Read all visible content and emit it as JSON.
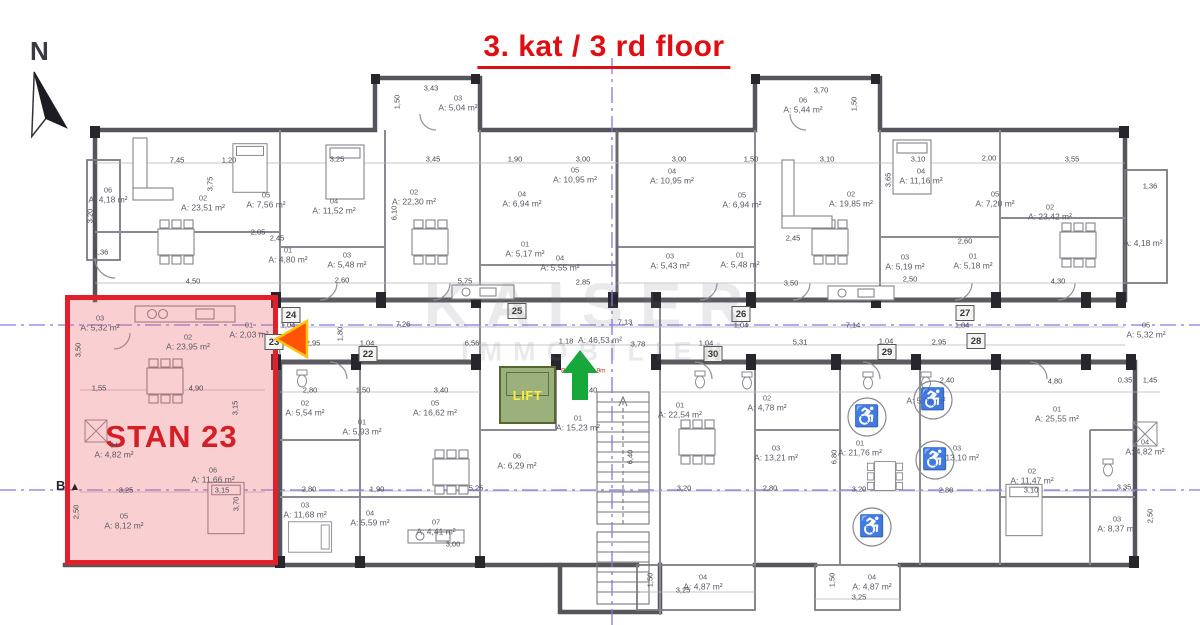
{
  "title": "3. kat / 3 rd floor",
  "compass": {
    "label": "N"
  },
  "section_marker": {
    "label": "B"
  },
  "watermark": {
    "line1": "KAISER",
    "line2": "IMMOBILIEN"
  },
  "highlight": {
    "label": "STAN 23"
  },
  "lift": {
    "label": "LIFT"
  },
  "icons": {
    "wheelchair": "♿"
  },
  "colors": {
    "highlight_border": "#e32029",
    "highlight_fill": "rgba(237,96,102,0.30)",
    "title_red": "#e00d12",
    "lift_green": "#9cb07c",
    "lift_text": "#f9f23b",
    "arrow_green": "#17a83b",
    "arrow_orange": "#ff5305",
    "axis_purple": "#8677e2"
  },
  "arrow_notes": [
    {
      "t": "B2",
      "x": 565,
      "y": 371
    },
    {
      "t": "-9m",
      "x": 600,
      "y": 371
    }
  ],
  "rooms": [
    {
      "u": "06",
      "a": "A: 4,18 m²",
      "x": 108,
      "y": 195
    },
    {
      "u": "02",
      "a": "A: 23,51 m²",
      "x": 203,
      "y": 203
    },
    {
      "u": "05",
      "a": "A: 7,56 m²",
      "x": 266,
      "y": 200
    },
    {
      "u": "01",
      "a": "A: 4,80 m²",
      "x": 288,
      "y": 255
    },
    {
      "u": "04",
      "a": "A: 11,52 m²",
      "x": 334,
      "y": 206
    },
    {
      "u": "03",
      "a": "A: 5,48 m²",
      "x": 347,
      "y": 260
    },
    {
      "u": "02",
      "a": "A: 22,30 m²",
      "x": 414,
      "y": 197
    },
    {
      "u": "03",
      "a": "A: 5,04 m²",
      "x": 458,
      "y": 103
    },
    {
      "u": "04",
      "a": "A: 6,94 m²",
      "x": 522,
      "y": 199
    },
    {
      "u": "05",
      "a": "A: 10,95 m²",
      "x": 575,
      "y": 175
    },
    {
      "u": "01",
      "a": "A: 5,17 m²",
      "x": 525,
      "y": 249
    },
    {
      "u": "04",
      "a": "A: 5,55 m²",
      "x": 560,
      "y": 263
    },
    {
      "u": "04",
      "a": "A: 10,95 m²",
      "x": 672,
      "y": 176
    },
    {
      "u": "05",
      "a": "A: 6,94 m²",
      "x": 742,
      "y": 200
    },
    {
      "u": "03",
      "a": "A: 5,43 m²",
      "x": 670,
      "y": 261
    },
    {
      "u": "01",
      "a": "A: 5,48 m²",
      "x": 740,
      "y": 260
    },
    {
      "u": "02",
      "a": "A: 19,85 m²",
      "x": 851,
      "y": 199
    },
    {
      "u": "06",
      "a": "A: 5,44 m²",
      "x": 803,
      "y": 105
    },
    {
      "u": "04",
      "a": "A: 11,16 m²",
      "x": 921,
      "y": 176
    },
    {
      "u": "05",
      "a": "A: 7,20 m²",
      "x": 995,
      "y": 199
    },
    {
      "u": "03",
      "a": "A: 5,19 m²",
      "x": 905,
      "y": 262
    },
    {
      "u": "01",
      "a": "A: 5,18 m²",
      "x": 973,
      "y": 261
    },
    {
      "u": "02",
      "a": "A: 23,42 m²",
      "x": 1050,
      "y": 212
    },
    {
      "u": "",
      "a": "A: 4,18 m²",
      "x": 1143,
      "y": 243
    },
    {
      "u": "05",
      "a": "A: 5,32 m²",
      "x": 1146,
      "y": 330
    },
    {
      "u": "",
      "a": "A: 46,53 m²",
      "x": 600,
      "y": 340
    },
    {
      "u": "03",
      "a": "A: 5,32 m²",
      "x": 100,
      "y": 323
    },
    {
      "u": "02",
      "a": "A: 23,95 m²",
      "x": 188,
      "y": 342
    },
    {
      "u": "01",
      "a": "A: 2,03 m²",
      "x": 249,
      "y": 330
    },
    {
      "u": "04",
      "a": "A: 4,82 m²",
      "x": 114,
      "y": 450
    },
    {
      "u": "06",
      "a": "A: 11,66 m²",
      "x": 213,
      "y": 475
    },
    {
      "u": "05",
      "a": "A: 8,12 m²",
      "x": 124,
      "y": 521
    },
    {
      "u": "02",
      "a": "A: 5,54 m²",
      "x": 305,
      "y": 408
    },
    {
      "u": "01",
      "a": "A: 5,93 m²",
      "x": 362,
      "y": 427
    },
    {
      "u": "05",
      "a": "A: 16,62 m²",
      "x": 435,
      "y": 408
    },
    {
      "u": "03",
      "a": "A: 11,68 m²",
      "x": 305,
      "y": 510
    },
    {
      "u": "04",
      "a": "A: 5,59 m²",
      "x": 370,
      "y": 518
    },
    {
      "u": "07",
      "a": "A: 4,41 m²",
      "x": 436,
      "y": 527
    },
    {
      "u": "06",
      "a": "A: 6,29 m²",
      "x": 517,
      "y": 461
    },
    {
      "u": "01",
      "a": "A: 15,23 m²",
      "x": 578,
      "y": 423
    },
    {
      "u": "01",
      "a": "A: 22,54 m²",
      "x": 680,
      "y": 410
    },
    {
      "u": "02",
      "a": "A: 4,78 m²",
      "x": 767,
      "y": 403
    },
    {
      "u": "03",
      "a": "A: 13,21 m²",
      "x": 776,
      "y": 453
    },
    {
      "u": "01",
      "a": "A: 21,76 m²",
      "x": 860,
      "y": 448
    },
    {
      "u": "02",
      "a": "A: 5,68 m²",
      "x": 926,
      "y": 396
    },
    {
      "u": "03",
      "a": "A: 13,10 m²",
      "x": 957,
      "y": 453
    },
    {
      "u": "01",
      "a": "A: 25,55 m²",
      "x": 1057,
      "y": 414
    },
    {
      "u": "02",
      "a": "A: 11,47 m²",
      "x": 1032,
      "y": 476
    },
    {
      "u": "04",
      "a": "A: 4,82 m²",
      "x": 1145,
      "y": 447
    },
    {
      "u": "03",
      "a": "A: 8,37 m²",
      "x": 1117,
      "y": 524
    },
    {
      "u": "04",
      "a": "A: 4,87 m²",
      "x": 703,
      "y": 582
    },
    {
      "u": "04",
      "a": "A: 4,87 m²",
      "x": 872,
      "y": 582
    }
  ],
  "markers": [
    {
      "n": "22",
      "x": 368,
      "y": 354
    },
    {
      "n": "23",
      "x": 274,
      "y": 342
    },
    {
      "n": "24",
      "x": 291,
      "y": 315
    },
    {
      "n": "25",
      "x": 517,
      "y": 311
    },
    {
      "n": "26",
      "x": 741,
      "y": 314
    },
    {
      "n": "27",
      "x": 965,
      "y": 313
    },
    {
      "n": "28",
      "x": 976,
      "y": 341
    },
    {
      "n": "29",
      "x": 887,
      "y": 352
    },
    {
      "n": "30",
      "x": 713,
      "y": 354
    }
  ],
  "accessibility": [
    {
      "x": 867,
      "y": 417
    },
    {
      "x": 872,
      "y": 527
    },
    {
      "x": 933,
      "y": 400
    },
    {
      "x": 935,
      "y": 460
    }
  ],
  "dims": [
    {
      "t": "3,43",
      "x": 431,
      "y": 88
    },
    {
      "t": "1,50",
      "x": 397,
      "y": 102,
      "r": 1
    },
    {
      "t": "3,70",
      "x": 821,
      "y": 90
    },
    {
      "t": "1,50",
      "x": 854,
      "y": 104,
      "r": 1
    },
    {
      "t": "7,45",
      "x": 177,
      "y": 160
    },
    {
      "t": "1,20",
      "x": 229,
      "y": 160
    },
    {
      "t": "3,25",
      "x": 337,
      "y": 159
    },
    {
      "t": "3,45",
      "x": 433,
      "y": 159
    },
    {
      "t": "1,90",
      "x": 515,
      "y": 159
    },
    {
      "t": "3,00",
      "x": 583,
      "y": 159
    },
    {
      "t": "3,00",
      "x": 679,
      "y": 159
    },
    {
      "t": "1,50",
      "x": 751,
      "y": 159
    },
    {
      "t": "3,10",
      "x": 827,
      "y": 159
    },
    {
      "t": "3,10",
      "x": 918,
      "y": 159
    },
    {
      "t": "2,00",
      "x": 989,
      "y": 158
    },
    {
      "t": "3,55",
      "x": 1072,
      "y": 159
    },
    {
      "t": "3,20",
      "x": 90,
      "y": 216,
      "r": 1
    },
    {
      "t": "1,36",
      "x": 101,
      "y": 252
    },
    {
      "t": "1,36",
      "x": 1150,
      "y": 186
    },
    {
      "t": "3,75",
      "x": 210,
      "y": 184,
      "r": 1
    },
    {
      "t": "6,10",
      "x": 394,
      "y": 213,
      "r": 1
    },
    {
      "t": "3,65",
      "x": 888,
      "y": 180,
      "r": 1
    },
    {
      "t": "2,05",
      "x": 258,
      "y": 232
    },
    {
      "t": "2,45",
      "x": 277,
      "y": 238
    },
    {
      "t": "2,45",
      "x": 793,
      "y": 238
    },
    {
      "t": "2,60",
      "x": 965,
      "y": 241
    },
    {
      "t": "4,50",
      "x": 193,
      "y": 281
    },
    {
      "t": "2,60",
      "x": 342,
      "y": 280
    },
    {
      "t": "5,75",
      "x": 465,
      "y": 281
    },
    {
      "t": "2,85",
      "x": 583,
      "y": 282
    },
    {
      "t": "3,50",
      "x": 791,
      "y": 283
    },
    {
      "t": "2,50",
      "x": 910,
      "y": 279
    },
    {
      "t": "4,30",
      "x": 1058,
      "y": 281
    },
    {
      "t": "1,04",
      "x": 288,
      "y": 325
    },
    {
      "t": "7,26",
      "x": 403,
      "y": 324
    },
    {
      "t": "7,13",
      "x": 625,
      "y": 322
    },
    {
      "t": "1,04",
      "x": 741,
      "y": 325
    },
    {
      "t": "7,14",
      "x": 853,
      "y": 325
    },
    {
      "t": "1,04",
      "x": 962,
      "y": 325
    },
    {
      "t": "2,95",
      "x": 313,
      "y": 343
    },
    {
      "t": "1,04",
      "x": 367,
      "y": 343
    },
    {
      "t": "6,56",
      "x": 472,
      "y": 343
    },
    {
      "t": "1,18",
      "x": 566,
      "y": 341
    },
    {
      "t": "3,78",
      "x": 638,
      "y": 344
    },
    {
      "t": "1,04",
      "x": 706,
      "y": 343
    },
    {
      "t": "5,31",
      "x": 800,
      "y": 342
    },
    {
      "t": "1,04",
      "x": 886,
      "y": 341
    },
    {
      "t": "2,95",
      "x": 939,
      "y": 342
    },
    {
      "t": "1,80",
      "x": 340,
      "y": 334,
      "r": 1
    },
    {
      "t": "2,40",
      "x": 590,
      "y": 390
    },
    {
      "t": "1,55",
      "x": 99,
      "y": 388
    },
    {
      "t": "4,90",
      "x": 196,
      "y": 388
    },
    {
      "t": "3,50",
      "x": 78,
      "y": 350,
      "r": 1
    },
    {
      "t": "3,15",
      "x": 235,
      "y": 408,
      "r": 1
    },
    {
      "t": "3,25",
      "x": 126,
      "y": 490
    },
    {
      "t": "3,15",
      "x": 222,
      "y": 490
    },
    {
      "t": "3,70",
      "x": 236,
      "y": 504,
      "r": 1
    },
    {
      "t": "2,50",
      "x": 76,
      "y": 512,
      "r": 1
    },
    {
      "t": "2,80",
      "x": 310,
      "y": 390
    },
    {
      "t": "1,50",
      "x": 363,
      "y": 390
    },
    {
      "t": "3,40",
      "x": 441,
      "y": 390
    },
    {
      "t": "2,40",
      "x": 947,
      "y": 380
    },
    {
      "t": "4,80",
      "x": 1055,
      "y": 381
    },
    {
      "t": "0,35",
      "x": 1125,
      "y": 380
    },
    {
      "t": "1,45",
      "x": 1150,
      "y": 380
    },
    {
      "t": "2,80",
      "x": 309,
      "y": 489
    },
    {
      "t": "1,90",
      "x": 377,
      "y": 489
    },
    {
      "t": "5,25",
      "x": 476,
      "y": 488
    },
    {
      "t": "3,20",
      "x": 684,
      "y": 488
    },
    {
      "t": "2,80",
      "x": 770,
      "y": 488
    },
    {
      "t": "3,20",
      "x": 859,
      "y": 489
    },
    {
      "t": "2,80",
      "x": 946,
      "y": 490
    },
    {
      "t": "3,10",
      "x": 1031,
      "y": 490
    },
    {
      "t": "3,35",
      "x": 1124,
      "y": 487
    },
    {
      "t": "6,40",
      "x": 630,
      "y": 457,
      "r": 1
    },
    {
      "t": "6,80",
      "x": 834,
      "y": 457,
      "r": 1
    },
    {
      "t": "2,50",
      "x": 1150,
      "y": 516,
      "r": 1
    },
    {
      "t": "3,00",
      "x": 453,
      "y": 544
    },
    {
      "t": "3,25",
      "x": 683,
      "y": 590
    },
    {
      "t": "3,25",
      "x": 859,
      "y": 597
    },
    {
      "t": "1,50",
      "x": 650,
      "y": 580,
      "r": 1
    },
    {
      "t": "1,50",
      "x": 832,
      "y": 580,
      "r": 1
    }
  ]
}
